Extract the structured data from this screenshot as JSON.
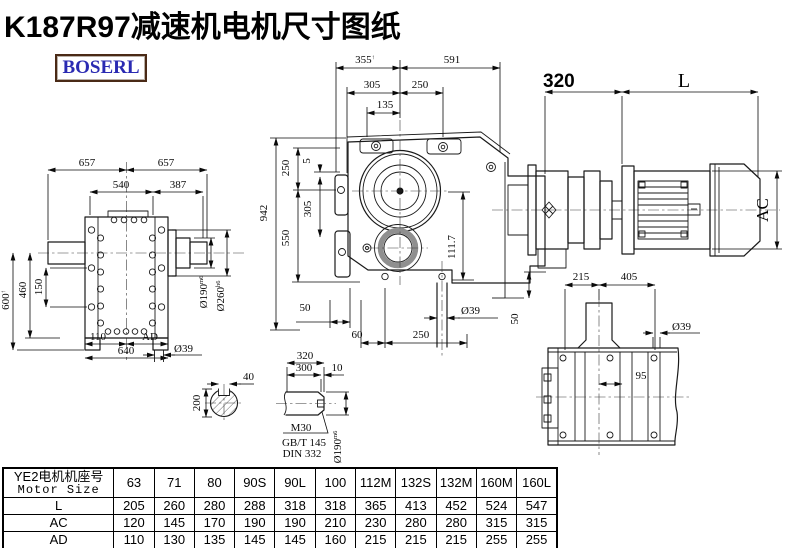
{
  "title": "K187R97减速机电机尺寸图纸",
  "logo": {
    "text": "BOSERL"
  },
  "colors": {
    "title": "#000000",
    "logo_text": "#2a2ab2",
    "logo_border": "#4a2a16",
    "line": "#1a1a1a"
  },
  "views": {
    "left_view": {
      "dim_657_left": "657",
      "dim_657_right": "657",
      "dim_540": "540",
      "dim_387": "387",
      "dim_600": "600",
      "dim_600_sup": "↑",
      "dim_460": "460",
      "dim_150": "150",
      "dim_110": "110",
      "dim_ad": "AD",
      "dim_640": "640",
      "dim_d39": "Ø39",
      "dim_d190": "Ø190",
      "dim_d190_tol": "m6",
      "dim_d260": "Ø260",
      "dim_d260_tol": "h6"
    },
    "front_view": {
      "dim_355": "355",
      "dim_355_sup": "↑",
      "dim_591": "591",
      "dim_305_top": "305",
      "dim_250_top": "250",
      "dim_135": "135",
      "dim_250_left": "250",
      "dim_5": "5",
      "dim_305_left": "305",
      "dim_550": "550",
      "dim_942": "942",
      "dim_111_7": "111.7",
      "dim_50_bottom": "50",
      "dim_60": "60",
      "dim_250_bottom": "250",
      "dim_d39": "Ø39",
      "dim_50_right": "50"
    },
    "side_view": {
      "dim_320": "320",
      "dim_L": "L",
      "dim_AC": "AC",
      "dim_215": "215",
      "dim_405": "405"
    },
    "top_view": {
      "dim_d39": "Ø39",
      "dim_95": "95"
    },
    "section_view": {
      "dim_40": "40",
      "dim_200": "200"
    },
    "shaft_detail": {
      "dim_320": "320",
      "dim_300": "300",
      "dim_10": "10",
      "label_m30": "M30",
      "label_gbt": "GB/T 145",
      "label_din": "DIN 332",
      "dim_d190": "Ø190",
      "dim_d190_tol": "m6"
    }
  },
  "table": {
    "header_cn": "YE2电机机座号",
    "header_en": "Motor Size",
    "columns": [
      "63",
      "71",
      "80",
      "90S",
      "90L",
      "100",
      "112M",
      "132S",
      "132M",
      "160M",
      "160L"
    ],
    "rows": [
      {
        "label": "L",
        "values": [
          "205",
          "260",
          "280",
          "288",
          "318",
          "318",
          "365",
          "413",
          "452",
          "524",
          "547"
        ]
      },
      {
        "label": "AC",
        "values": [
          "120",
          "145",
          "170",
          "190",
          "190",
          "210",
          "230",
          "280",
          "280",
          "315",
          "315"
        ]
      },
      {
        "label": "AD",
        "values": [
          "110",
          "130",
          "135",
          "145",
          "145",
          "160",
          "215",
          "215",
          "215",
          "255",
          "255"
        ]
      }
    ]
  }
}
